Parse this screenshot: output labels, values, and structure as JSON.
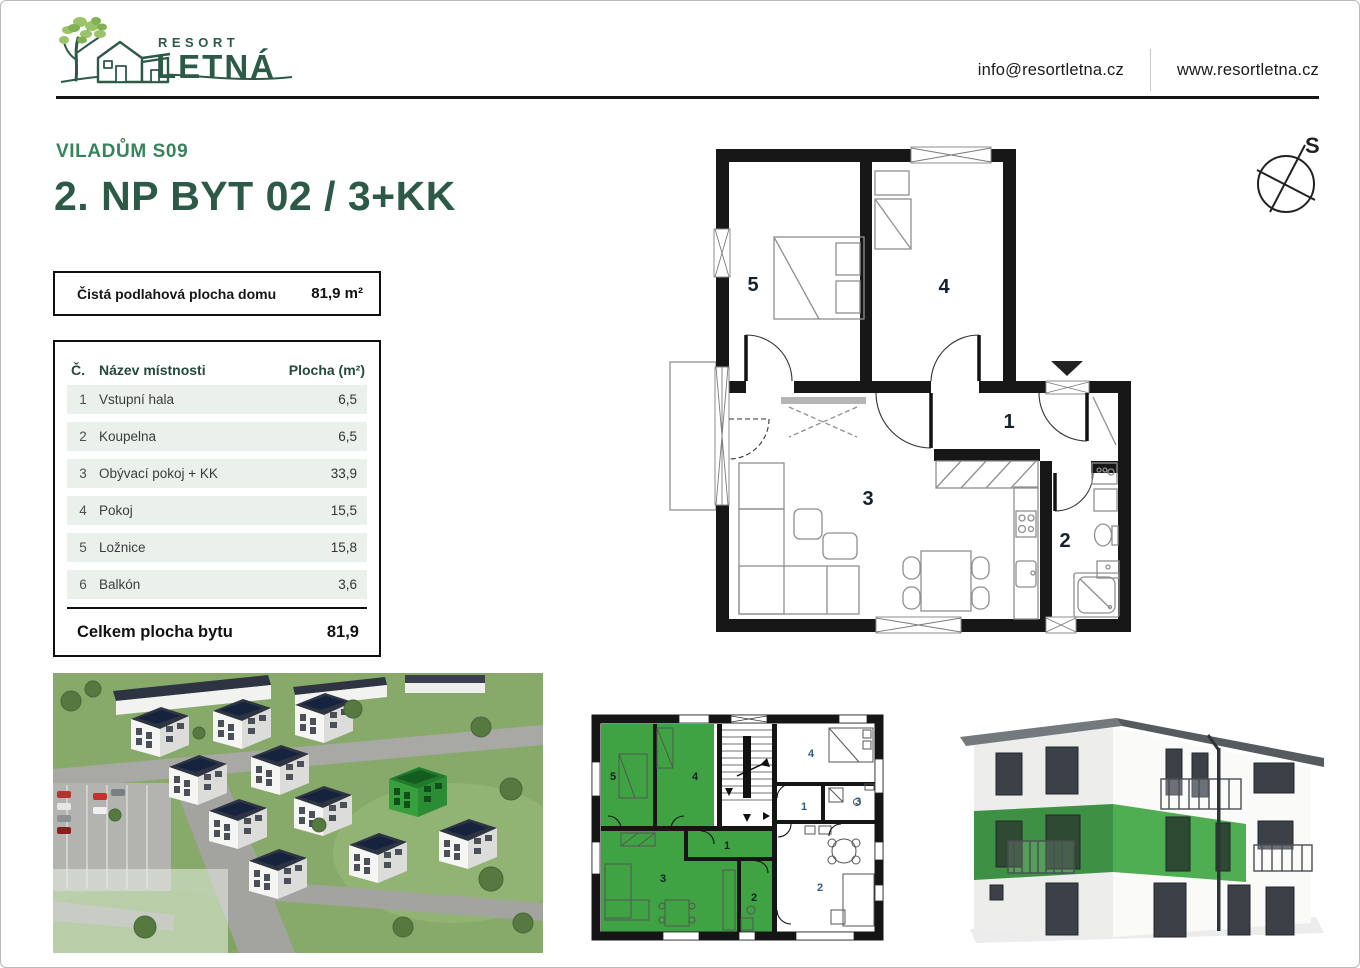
{
  "header": {
    "brand_top": "RESORT",
    "brand_main": "LETNÁ",
    "email": "info@resortletna.cz",
    "website": "www.resortletna.cz"
  },
  "title": {
    "project": "VILADŮM S09",
    "unit": "2. NP BYT 02 / 3+KK"
  },
  "compass": {
    "north_label": "S"
  },
  "area_box": {
    "label": "Čistá podlahová plocha domu",
    "value": "81,9 m²"
  },
  "room_table": {
    "col_number": "Č.",
    "col_name": "Název místnosti",
    "col_area": "Plocha (m²)",
    "rows": [
      {
        "n": "1",
        "name": "Vstupní hala",
        "area": "6,5"
      },
      {
        "n": "2",
        "name": "Koupelna",
        "area": "6,5"
      },
      {
        "n": "3",
        "name": "Obývací pokoj + KK",
        "area": "33,9"
      },
      {
        "n": "4",
        "name": "Pokoj",
        "area": "15,5"
      },
      {
        "n": "5",
        "name": "Ložnice",
        "area": "15,8"
      },
      {
        "n": "6",
        "name": "Balkón",
        "area": "3,6"
      }
    ],
    "total_label": "Celkem plocha bytu",
    "total_value": "81,9"
  },
  "floor_plan": {
    "labels": {
      "hall": "1",
      "bath": "2",
      "living": "3",
      "room": "4",
      "bedroom": "5"
    }
  },
  "overview_plan": {
    "green_unit": {
      "bedroom": "5",
      "room": "4",
      "living": "3",
      "hall": "1",
      "bath": "2"
    },
    "white_unit": {
      "room": "4",
      "hall": "1",
      "bath": "3",
      "living": "2"
    }
  },
  "colors": {
    "brand_dark": "#2d5a47",
    "brand_green": "#37835c",
    "leaf_green": "#9bc46a",
    "row_bg": "#eaf1ec",
    "highlight_green": "#3fa344",
    "wall": "#171717",
    "label_blue": "#2e5a85"
  }
}
